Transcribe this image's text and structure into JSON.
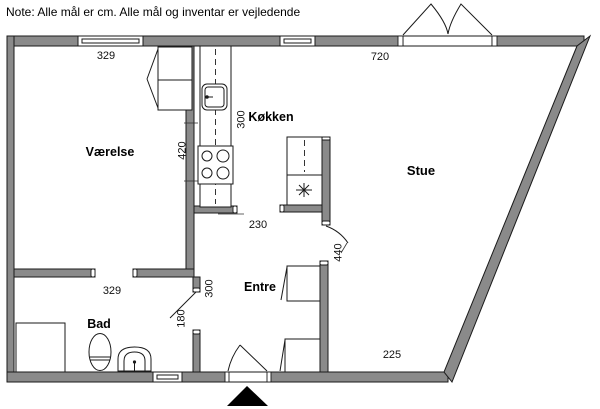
{
  "note": "Note: Alle mål er cm. Alle mål og inventar er vejledende",
  "rooms": {
    "vaerelse": "Værelse",
    "koekken": "Køkken",
    "stue": "Stue",
    "entre": "Entre",
    "bad": "Bad"
  },
  "dimensions": {
    "vaerelse_top_width": "329",
    "stue_top_width": "720",
    "koekken_height": "420",
    "koekken_width": "300",
    "koekken_opening": "230",
    "stue_entry": "440",
    "entre_width": "300",
    "bad_top_width": "329",
    "bad_door": "180",
    "stue_bottom": "225"
  },
  "colors": {
    "wall": "#8a8a8a",
    "line": "#1a1a1a",
    "text": "#000000",
    "entrance_marker": "#000000"
  },
  "fixtures": [
    "window-icon",
    "double-door-icon",
    "entrance-door-icon",
    "interior-door-icon",
    "kitchen-sink-icon",
    "stove-icon",
    "refrigerator-icon",
    "lamp-asterisk-icon",
    "wardrobe-icon",
    "closet-icon",
    "shower-icon",
    "toilet-icon",
    "washbasin-icon",
    "entrance-arrow-icon"
  ]
}
